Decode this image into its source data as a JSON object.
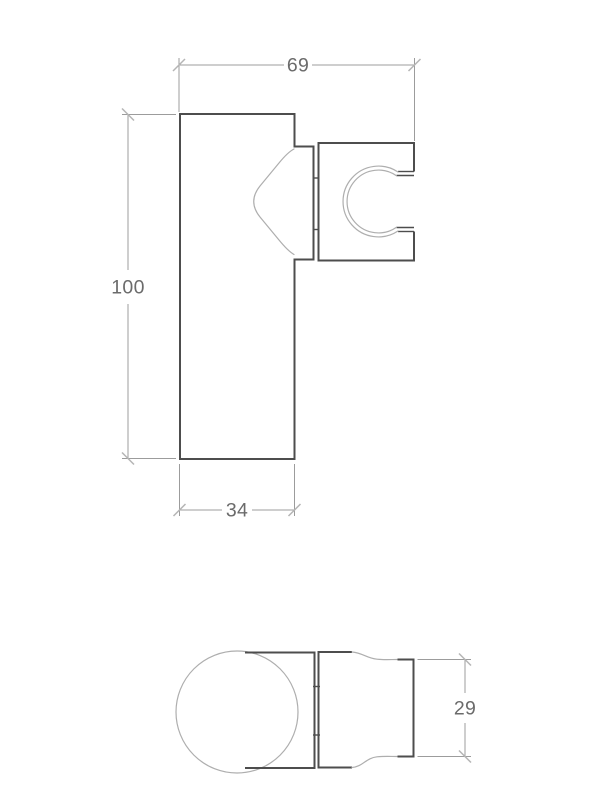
{
  "drawing": {
    "front_view": {
      "dim_top_width": "69",
      "dim_height": "100",
      "dim_bottom_width": "34"
    },
    "plan_view": {
      "dim_end_height": "29"
    },
    "colors": {
      "outline": "#4d4d4d",
      "profile_line": "#aeaeae",
      "dimension_line": "#9c9c9c",
      "tick_mark": "#b5b5b5",
      "dimension_text": "#6b6b6b",
      "background": "#ffffff"
    }
  }
}
